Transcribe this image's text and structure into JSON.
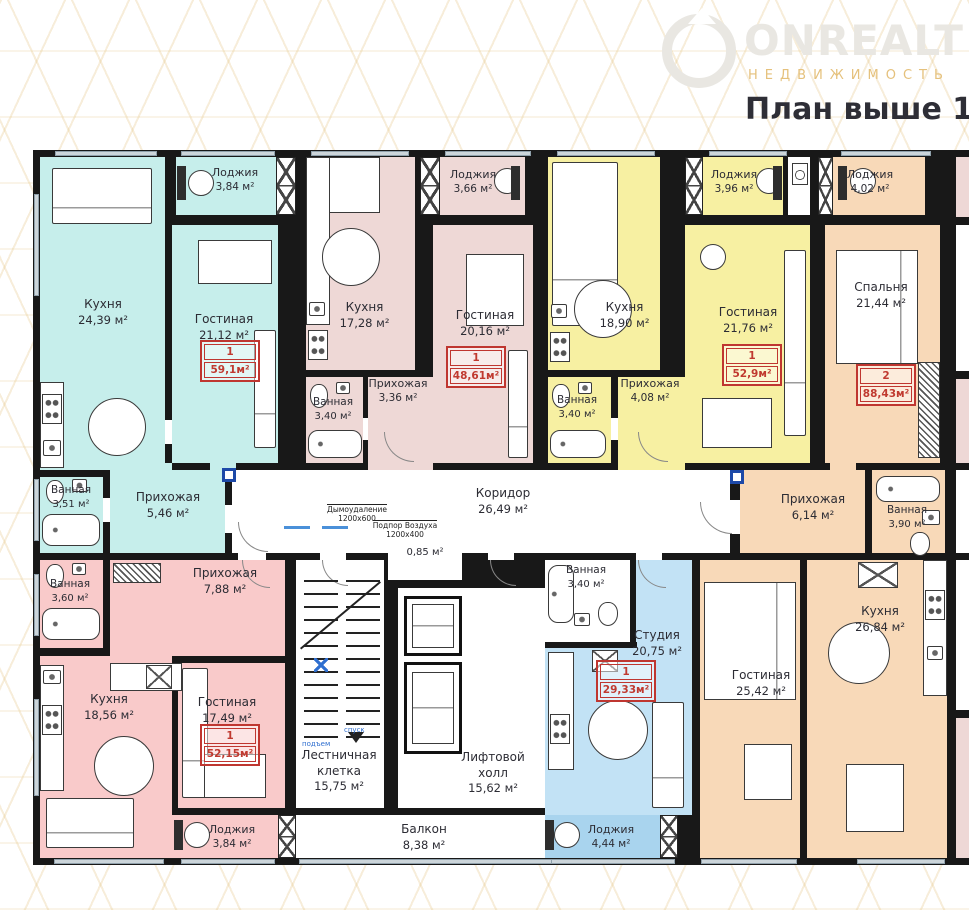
{
  "header": {
    "title": "План выше 1 эт",
    "logo": {
      "brand": "ONREALT",
      "tagline": "НЕДВИЖИМОСТЬ"
    }
  },
  "rooms": {
    "apt1_kitchen": {
      "name": "Кухня",
      "area": "24,39 м²"
    },
    "apt1_loggia": {
      "name": "Лоджия",
      "area": "3,84 м²"
    },
    "apt1_living": {
      "name": "Гостиная",
      "area": "21,12 м²"
    },
    "apt1_bath": {
      "name": "Ванная",
      "area": "3,51 м²"
    },
    "apt1_hall": {
      "name": "Прихожая",
      "area": "5,46 м²"
    },
    "apt2_kitchen": {
      "name": "Кухня",
      "area": "17,28 м²"
    },
    "apt2_loggia": {
      "name": "Лоджия",
      "area": "3,66 м²"
    },
    "apt2_living": {
      "name": "Гостиная",
      "area": "20,16 м²"
    },
    "apt2_hall": {
      "name": "Прихожая",
      "area": "3,36 м²"
    },
    "apt2_bath": {
      "name": "Ванная",
      "area": "3,40 м²"
    },
    "apt3_kitchen": {
      "name": "Кухня",
      "area": "18,90 м²"
    },
    "apt3_loggia": {
      "name": "Лоджия",
      "area": "3,96 м²"
    },
    "apt3_living": {
      "name": "Гостиная",
      "area": "21,76 м²"
    },
    "apt3_bath": {
      "name": "Ванная",
      "area": "3,40 м²"
    },
    "apt3_hall": {
      "name": "Прихожая",
      "area": "4,08 м²"
    },
    "apt4_loggia": {
      "name": "Лоджия",
      "area": "4,02 м²"
    },
    "apt4_bedroom": {
      "name": "Спальня",
      "area": "21,44 м²"
    },
    "apt4_hall": {
      "name": "Прихожая",
      "area": "6,14 м²"
    },
    "apt4_bath": {
      "name": "Ванная",
      "area": "3,90 м²"
    },
    "apt4_kitchen": {
      "name": "Кухня",
      "area": "26,84 м²"
    },
    "apt4_living": {
      "name": "Гостиная",
      "area": "25,42 м²"
    },
    "corridor": {
      "name": "Коридор",
      "area": "26,49 м²"
    },
    "closet": {
      "name": "",
      "area": "0,85 м²"
    },
    "stairs": {
      "name": "Лестничная клетка",
      "area": "15,75 м²"
    },
    "lift_hall": {
      "name": "Лифтовой холл",
      "area": "15,62 м²"
    },
    "balcony": {
      "name": "Балкон",
      "area": "8,38 м²"
    },
    "apt5_bath": {
      "name": "Ванная",
      "area": "3,60 м²"
    },
    "apt5_hall": {
      "name": "Прихожая",
      "area": "7,88 м²"
    },
    "apt5_kitchen": {
      "name": "Кухня",
      "area": "18,56 м²"
    },
    "apt5_living": {
      "name": "Гостиная",
      "area": "17,49 м²"
    },
    "apt5_loggia": {
      "name": "Лоджия",
      "area": "3,84 м²"
    },
    "apt6_bath": {
      "name": "Ванная",
      "area": "3,40 м²"
    },
    "apt6_studio": {
      "name": "Студия",
      "area": "20,75 м²"
    },
    "apt6_loggia": {
      "name": "Лоджия",
      "area": "4,44 м²"
    }
  },
  "badges": {
    "apt1": {
      "num": "1",
      "area": "59,1м²"
    },
    "apt2": {
      "num": "1",
      "area": "48,61м²"
    },
    "apt3": {
      "num": "1",
      "area": "52,9м²"
    },
    "apt4": {
      "num": "2",
      "area": "88,43м²"
    },
    "apt5": {
      "num": "1",
      "area": "52,15м²"
    },
    "apt6": {
      "num": "1",
      "area": "29,33м²"
    }
  },
  "annotations": {
    "smoke_label": "Дымоудаление",
    "smoke_size": "1200х600",
    "air_label": "Подпор Воздуха",
    "air_size": "1200х400",
    "stairs_up": "подъем",
    "stairs_down": "спуск"
  },
  "colors": {
    "badge_red": "#c03a30",
    "wall": "#181818",
    "accent_gold": "#e7c87f"
  }
}
